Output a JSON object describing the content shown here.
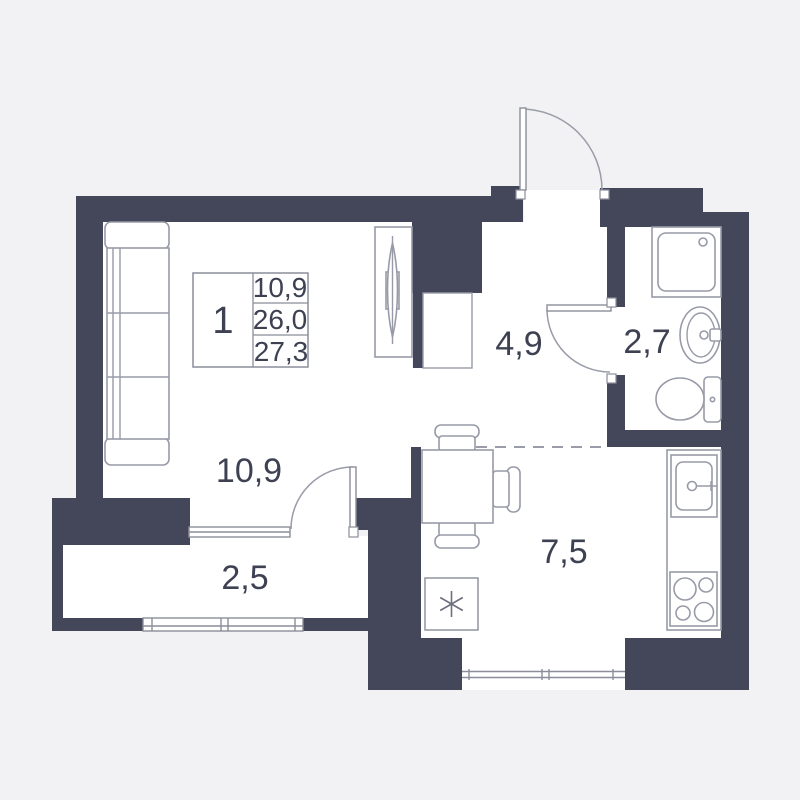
{
  "plan": {
    "type": "apartment-floor-plan",
    "apartment": {
      "number": "1",
      "living_area": "10,9",
      "area": "26,0",
      "total_area": "27,3"
    },
    "rooms": {
      "living": {
        "name": "living-room",
        "label": "10,9"
      },
      "hallway": {
        "name": "hallway",
        "label": "4,9"
      },
      "bathroom": {
        "name": "bathroom",
        "label": "2,7"
      },
      "kitchen": {
        "name": "kitchen",
        "label": "7,5"
      },
      "balcony": {
        "name": "balcony",
        "label": "2,5"
      }
    },
    "fixtures": [
      "sofa",
      "tv-unit",
      "wardrobe-niche",
      "dining-table",
      "chairs",
      "refrigerator",
      "kitchen-sink",
      "stove",
      "shower",
      "wash-basin",
      "toilet"
    ]
  },
  "colors": {
    "wall": "#434759",
    "background": "#f2f2f4",
    "floor": "#ffffff",
    "line": "#989ba7",
    "text": "#3d4152"
  }
}
